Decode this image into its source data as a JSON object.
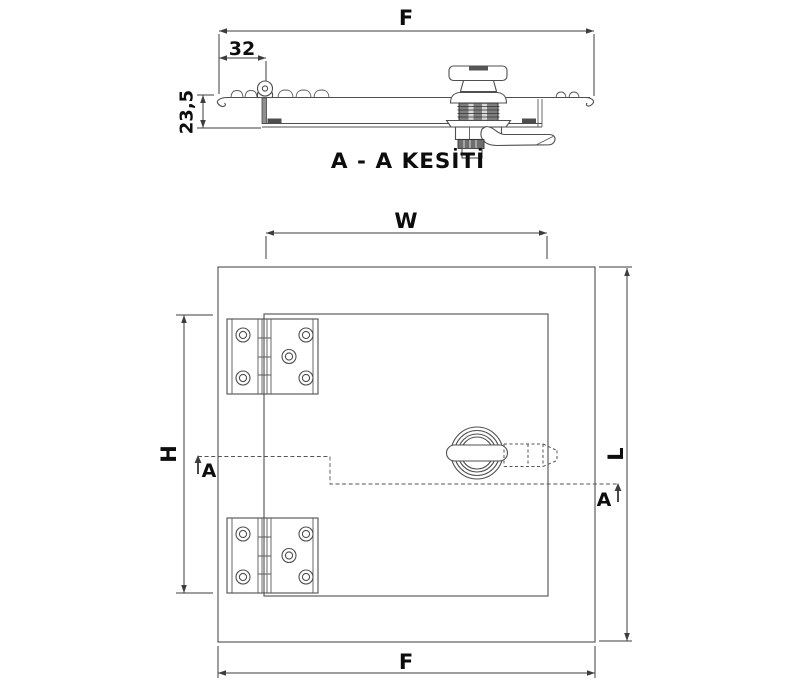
{
  "section_view": {
    "title": "A - A KESİTİ",
    "dimensions": {
      "total_width": "F",
      "hinge_offset": "32",
      "panel_depth": "23,5"
    }
  },
  "plan_view": {
    "dimensions": {
      "door_width": "W",
      "door_height": "H",
      "frame_length": "L",
      "frame_width": "F"
    },
    "section_cut": {
      "label_left": "A",
      "label_right": "A"
    }
  }
}
